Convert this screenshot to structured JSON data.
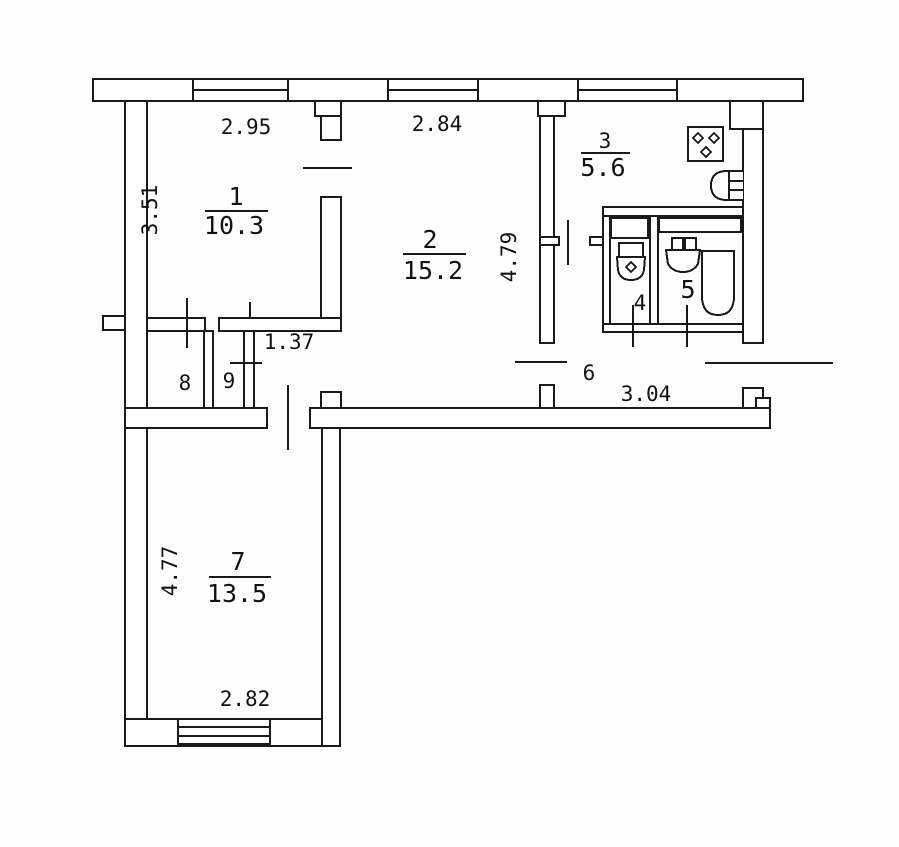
{
  "plan": {
    "type": "apartment-floor-plan",
    "colors": {
      "line": "#1a1a1a",
      "background": "#ffffff"
    },
    "rooms": {
      "room1": {
        "number": "1",
        "area": "10.3",
        "width": "2.95",
        "height": "3.51"
      },
      "room2": {
        "number": "2",
        "area": "15.2",
        "width": "2.84",
        "height": "4.79"
      },
      "room3": {
        "number": "3",
        "area": "5.6"
      },
      "room4": {
        "number": "4"
      },
      "room5": {
        "number": "5"
      },
      "room6": {
        "number": "6",
        "width": "3.04"
      },
      "room7": {
        "number": "7",
        "area": "13.5",
        "height": "4.77",
        "width": "2.82"
      },
      "room8": {
        "number": "8"
      },
      "room9": {
        "number": "9"
      },
      "hall": {
        "width": "1.37"
      }
    },
    "fixtures": [
      "stove-icon",
      "kitchen-sink-icon",
      "toilet-icon",
      "washbasin-icon",
      "bathtub-icon"
    ],
    "windows_count": 4,
    "entry": "right-side-door"
  }
}
